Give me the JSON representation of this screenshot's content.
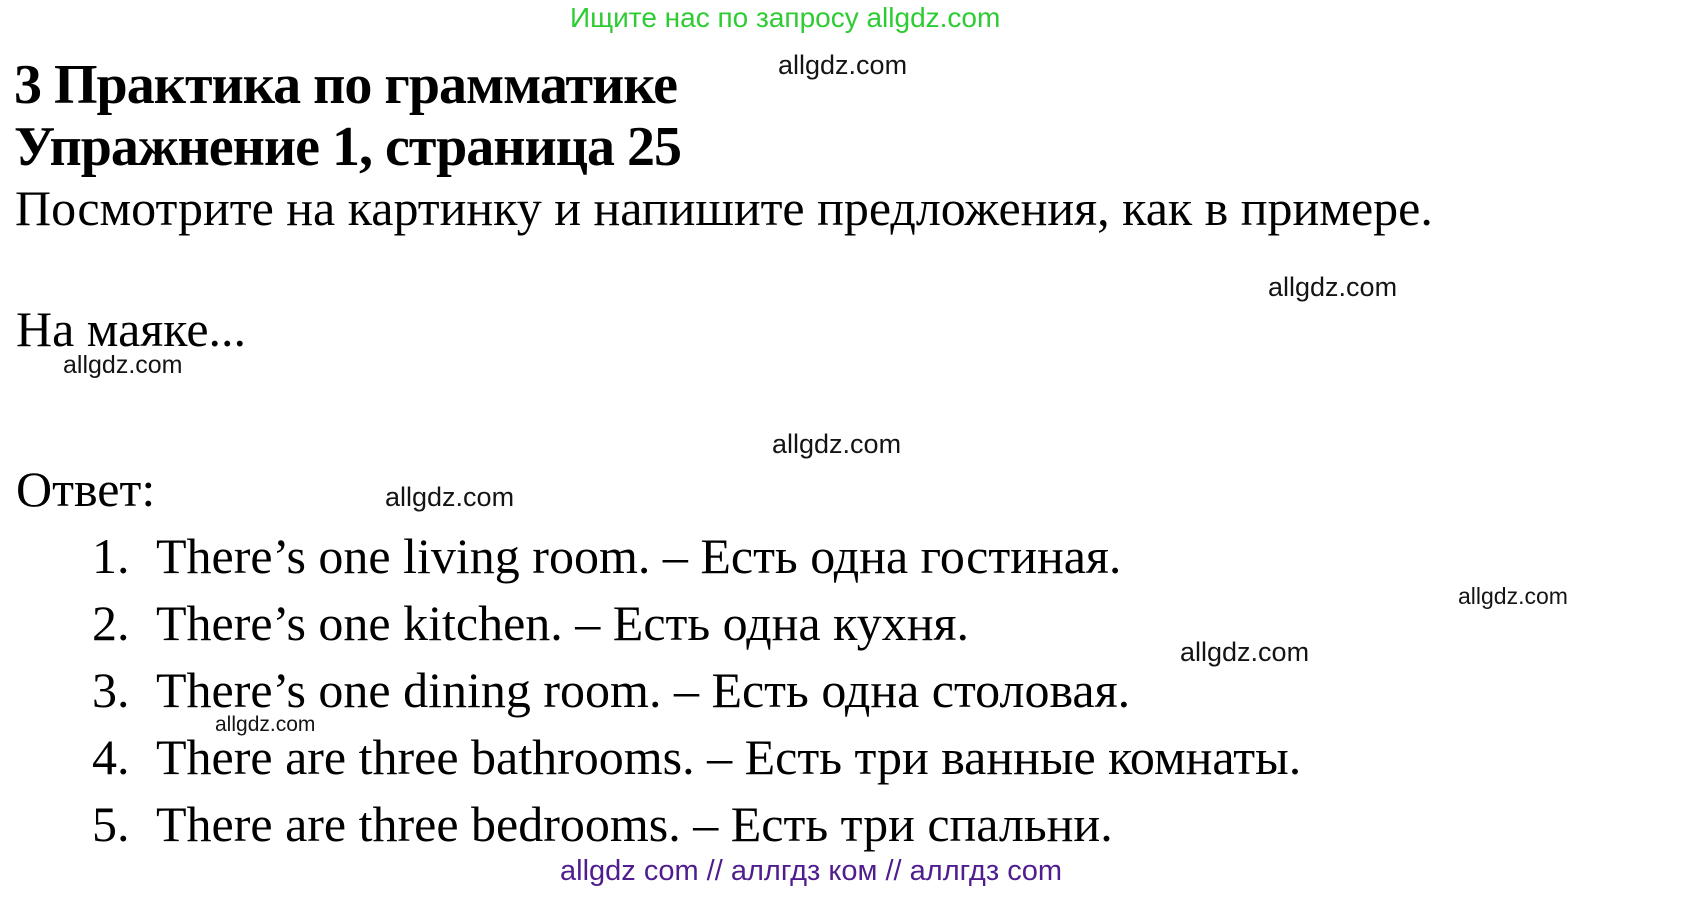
{
  "banner": {
    "text": "Ищите нас по запросу allgdz.com",
    "color": "#2ecc33"
  },
  "heading": {
    "line1": "3 Практика по грамматике",
    "line2": "Упражнение 1, страница 25"
  },
  "instruction": "Посмотрите на картинку и напишите предложения, как в примере.",
  "context_line": "На маяке...",
  "answer_label": "Ответ:",
  "answers": [
    {
      "num": "1.",
      "text": "There’s one living room. – Есть одна гостиная."
    },
    {
      "num": "2.",
      "text": "There’s one kitchen. – Есть одна кухня."
    },
    {
      "num": "3.",
      "text": "There’s one dining room. – Есть одна столовая."
    },
    {
      "num": "4.",
      "text": "There are three bathrooms. – Есть три ванные комнаты."
    },
    {
      "num": "5.",
      "text": "There are three bedrooms. – Есть три спальни."
    }
  ],
  "watermarks": [
    {
      "text": "allgdz.com"
    },
    {
      "text": "allgdz.com"
    },
    {
      "text": "allgdz.com"
    },
    {
      "text": "allgdz.com"
    },
    {
      "text": "allgdz.com"
    },
    {
      "text": "allgdz.com"
    },
    {
      "text": "allgdz.com"
    },
    {
      "text": "allgdz.com"
    }
  ],
  "footer": {
    "text": "allgdz com // аллгдз ком // аллгдз com",
    "color": "#4f1d8e"
  },
  "colors": {
    "background": "#ffffff",
    "text": "#000000",
    "banner_green": "#2ecc33",
    "footer_purple": "#4f1d8e",
    "watermark_gray": "#141414"
  }
}
